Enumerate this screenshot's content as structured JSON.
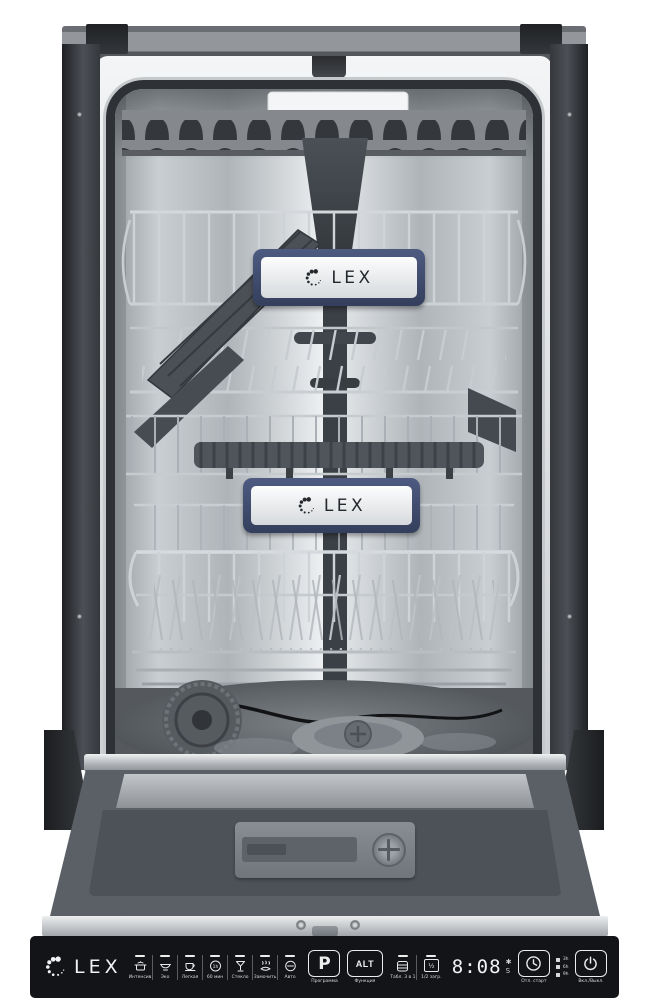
{
  "brand": {
    "name": "LEX"
  },
  "badges": {
    "upper": "LEX",
    "lower": "LEX"
  },
  "control_panel": {
    "brand": "LEX",
    "programs": [
      {
        "label": "Интенсив",
        "icon": "pot-icon"
      },
      {
        "label": "Эко",
        "icon": "bowl-icon"
      },
      {
        "label": "Легкая",
        "icon": "cup-icon"
      },
      {
        "label": "60 мин",
        "icon": "clock-1h-icon",
        "icon_text": "1h"
      },
      {
        "label": "Стекло",
        "icon": "wine-glass-icon"
      },
      {
        "label": "Замочить",
        "icon": "soak-icon"
      },
      {
        "label": "Авто",
        "icon": "auto-icon"
      }
    ],
    "program_button": {
      "label": "P",
      "caption": "Программа"
    },
    "alt_button": {
      "label": "ALT",
      "caption": "Функция"
    },
    "functions": [
      {
        "caption": "Табл. 3 в 1",
        "icon": "tablet-3in1-icon"
      },
      {
        "caption": "1/2 загр.",
        "icon": "half-load-icon",
        "glyph": "½"
      }
    ],
    "display": {
      "time": "8:08",
      "rinse_aid_glyph": "✱",
      "salt_glyph": "S"
    },
    "delay_start": {
      "caption": "Отл. старт",
      "icon": "delay-clock-icon"
    },
    "delay_hours": [
      "3h",
      "6h",
      "9h"
    ],
    "power": {
      "caption": "Вкл./Выкл.",
      "icon": "power-icon"
    }
  },
  "colors": {
    "panel_bg": "#131417",
    "badge_navy": "#3e4a6e",
    "steel_light": "#eef0f2",
    "steel_dark": "#8f959a",
    "cabinet_dark": "#3a3d42"
  }
}
